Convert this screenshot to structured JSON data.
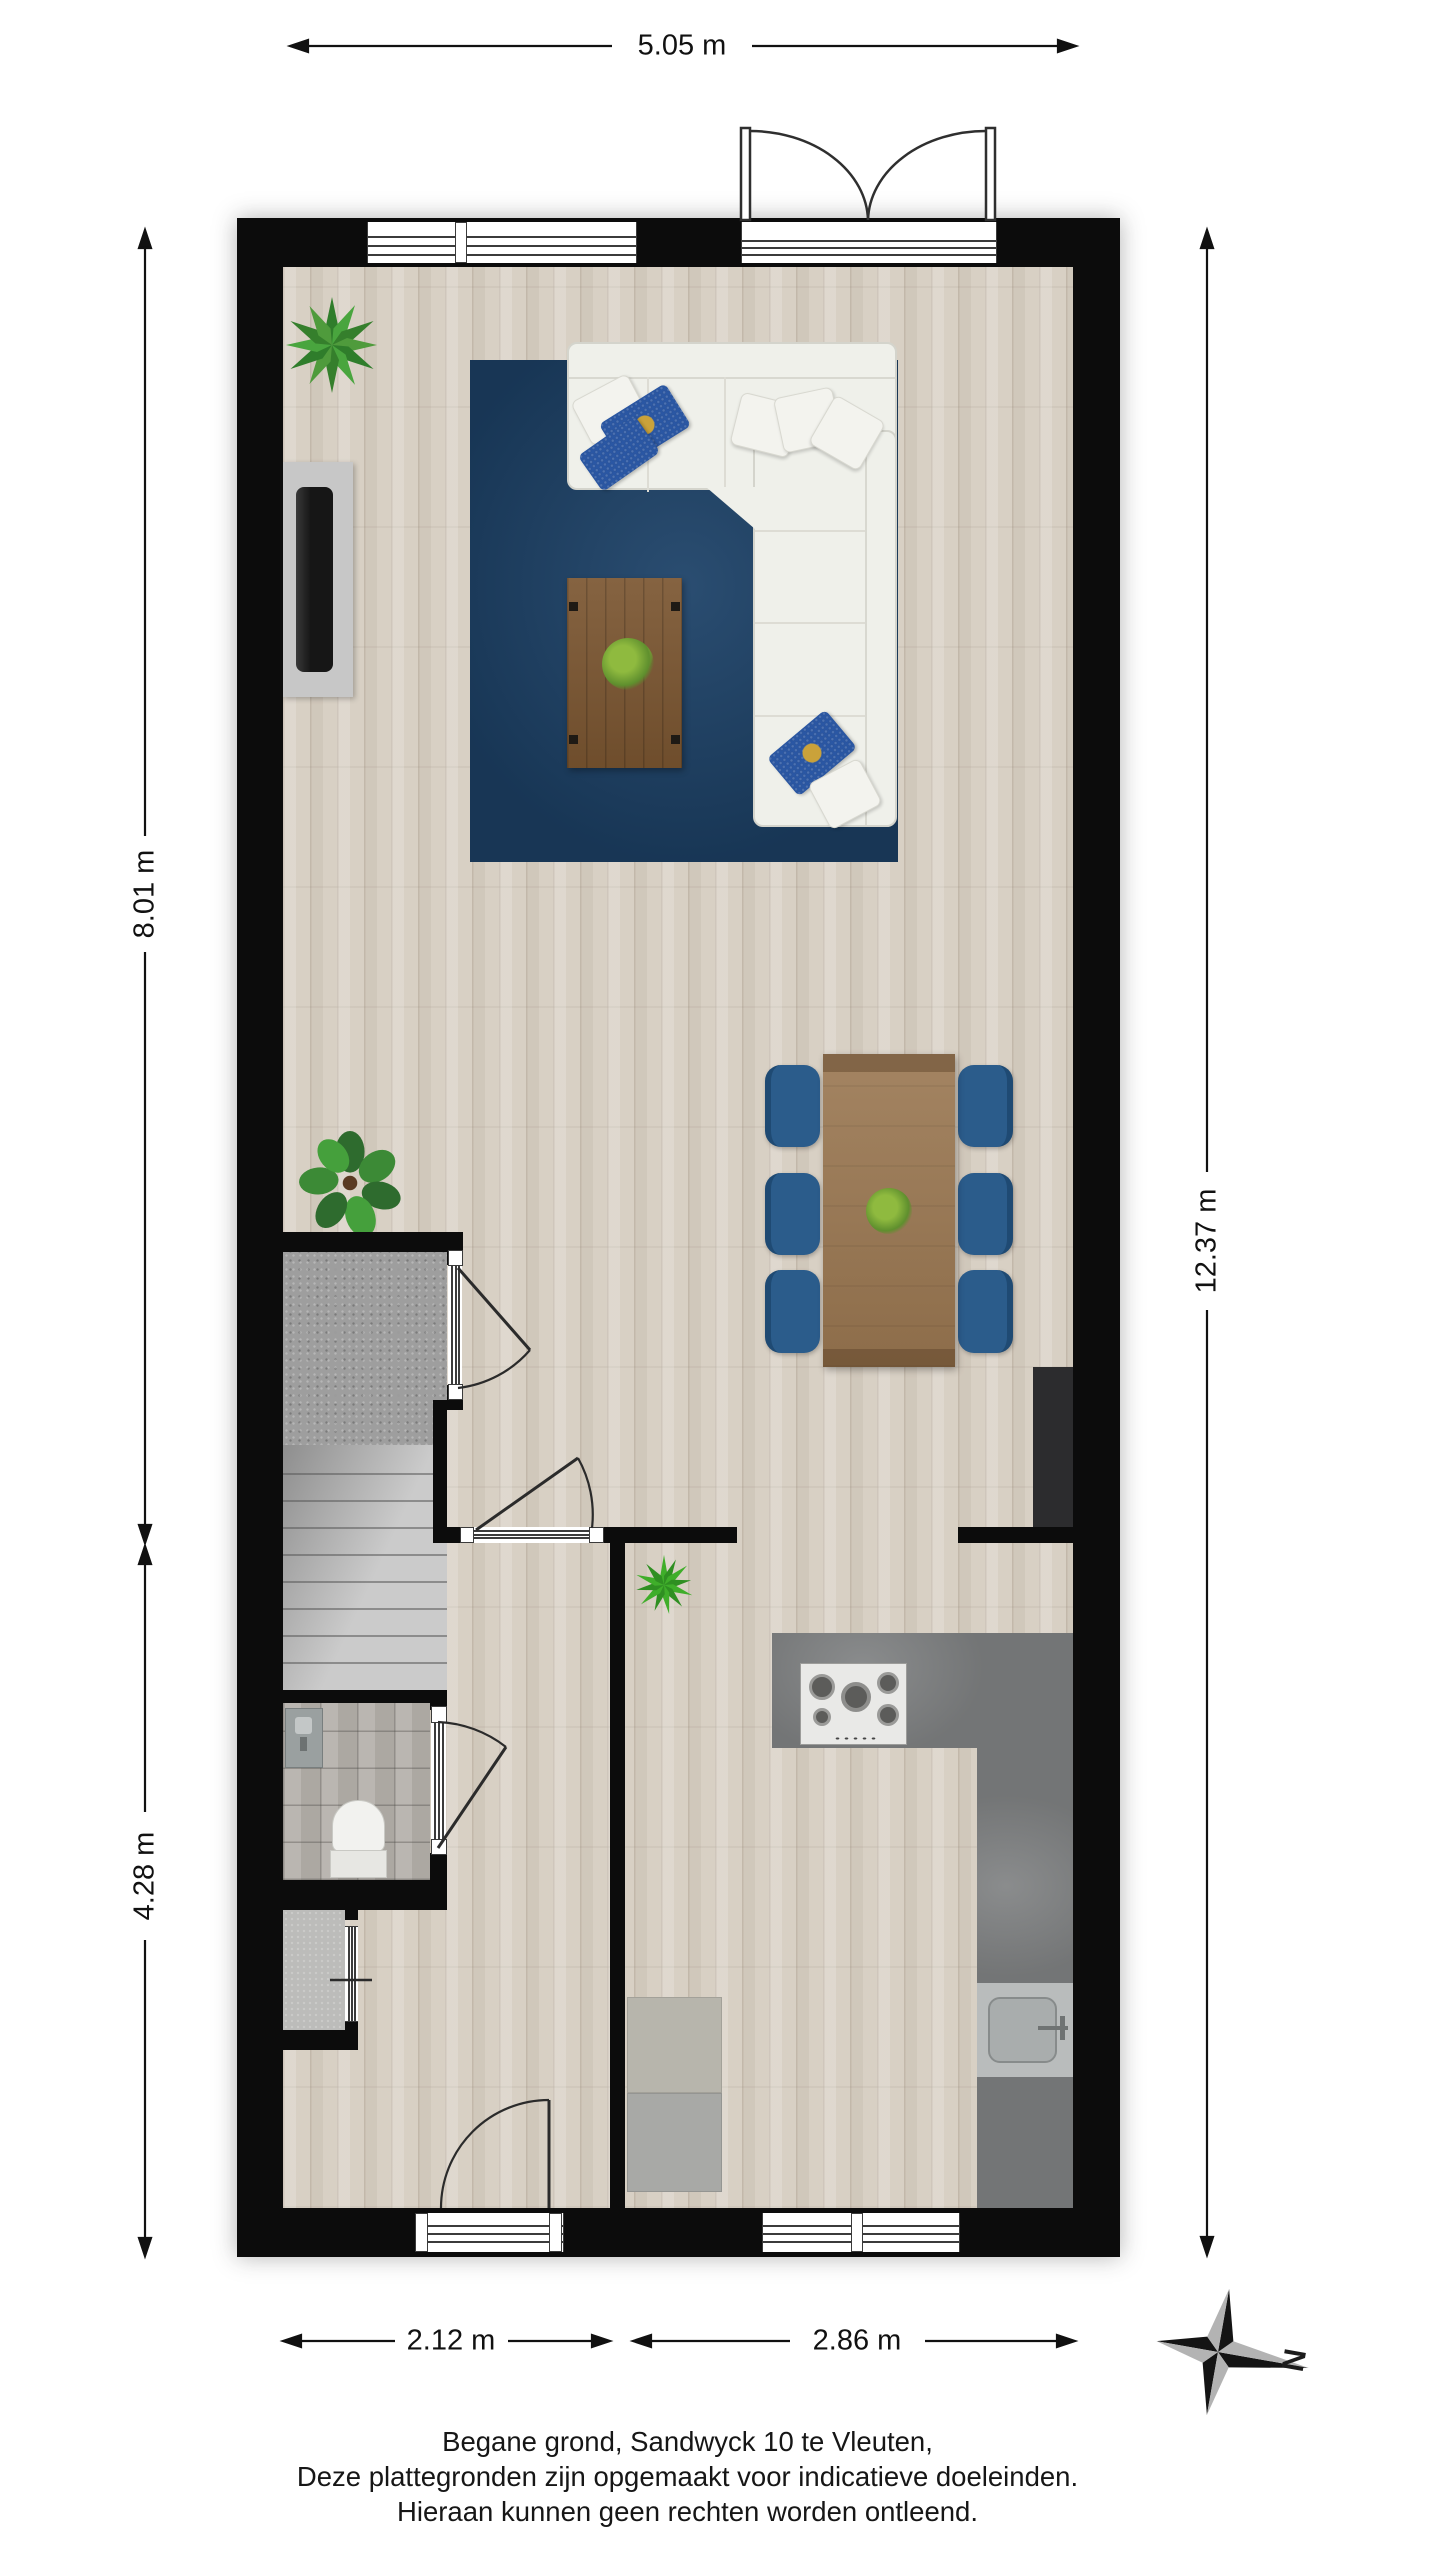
{
  "plan": {
    "type": "floorplan",
    "floor_name_context": "Begane grond (ground floor)"
  },
  "dimensions": {
    "top": {
      "label": "5.05 m"
    },
    "left_upper": {
      "label": "8.01 m"
    },
    "left_lower": {
      "label": "4.28 m"
    },
    "right": {
      "label": "12.37 m"
    },
    "bottom_left": {
      "label": "2.12 m"
    },
    "bottom_right": {
      "label": "2.86 m"
    }
  },
  "compass": {
    "north_label": "N"
  },
  "caption": {
    "line1": "Begane grond, Sandwyck 10 te Vleuten,",
    "line2": "Deze plattegronden zijn opgemaakt voor indicatieve doeleinden.",
    "line3": "Hieraan kunnen geen rechten worden ontleend."
  },
  "colors": {
    "wall": "#0c0c0c",
    "wood_floor": "#d8d0c4",
    "rug": "#1d4268",
    "sofa": "#eff0ea",
    "coffee_table": "#7b5631",
    "dining_table": "#997650",
    "dining_chair": "#2b5c8b",
    "kitchen_counter": "#7d7f80",
    "stairs": "#c9c9c9",
    "accent_pillow": "#2a57a4"
  }
}
